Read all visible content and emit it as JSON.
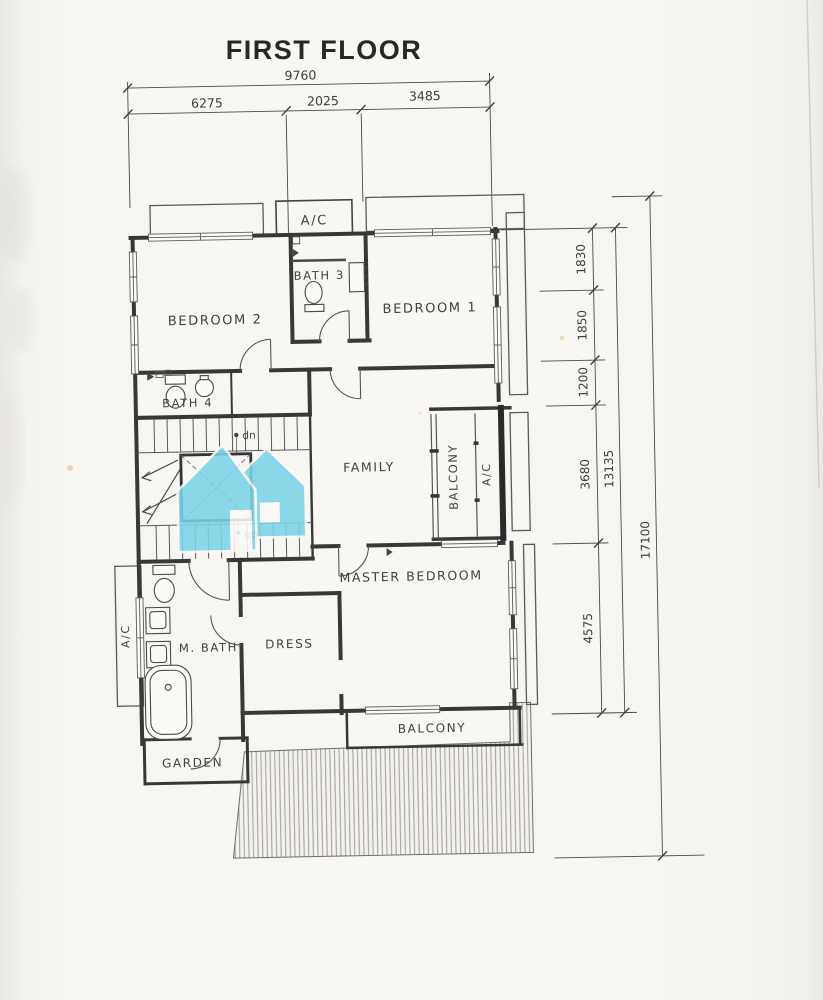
{
  "title": "FIRST FLOOR",
  "dimensions": {
    "top": {
      "overall": "9760",
      "segments": [
        "6275",
        "2025",
        "3485"
      ]
    },
    "right": {
      "inner": [
        "1830",
        "1850",
        "1200",
        "3680",
        "4575"
      ],
      "middle": "13135",
      "outer": "17100"
    }
  },
  "rooms": {
    "bedroom2": "BEDROOM 2",
    "bath3": "BATH 3",
    "bedroom1": "BEDROOM 1",
    "bath4": "BATH 4",
    "family": "FAMILY",
    "balcony_mid": "BALCONY",
    "ac_mid": "A/C",
    "ac_top": "A/C",
    "master_bedroom": "MASTER BEDROOM",
    "dress": "DRESS",
    "m_bath": "M. BATH",
    "ac_left": "A/C",
    "garden": "GARDEN",
    "balcony_bottom": "BALCONY"
  },
  "stairs": {
    "down": "dn",
    "up": "up"
  },
  "colors": {
    "watermark": "#7cd3e9",
    "ink": "#3a3a3a",
    "paper": "#f7f6f2"
  }
}
